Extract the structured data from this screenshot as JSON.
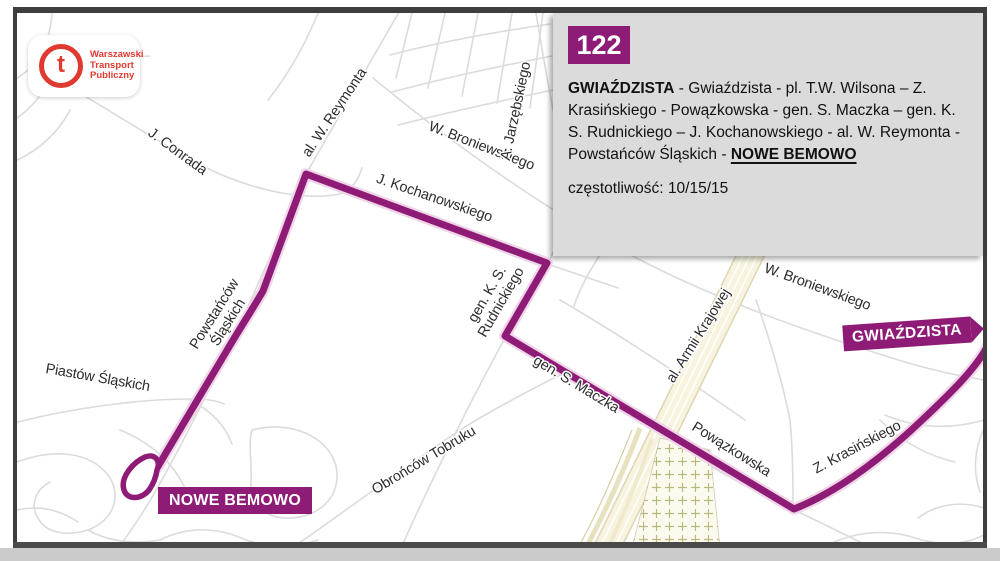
{
  "logo": {
    "t_letter": "t",
    "org_lines": [
      "Warszawski",
      "Transport",
      "Publiczny"
    ]
  },
  "info_box": {
    "route_number": "122",
    "route_from": "GWIAŹDZISTA",
    "route_middle": " - Gwiaździsta - pl. T.W. Wilsona – Z. Krasińskiego - Powązkowska - gen. S. Maczka – gen. K. S. Rudnickiego – J. Kochanowskiego - al. W. Reymonta - Powstańców Śląskich - ",
    "route_to": "NOWE BEMOWO",
    "frequency_label": "częstotliwość:",
    "frequency_value": "10/15/15"
  },
  "terminus_flags": {
    "gwiazdzista": "GWIAŹDZISTA",
    "nowe_bemowo": "NOWE BEMOWO"
  },
  "map": {
    "street_labels": [
      "J. Conrada",
      "al. W. Reymonta",
      "W. Broniewskiego",
      "A. Jarzębskiego",
      "J. Kochanowskiego",
      "gen. K. S.",
      "Rudnickiego",
      "gen. S. Maczka",
      "Obrońców Tobruku",
      "Piastów Śląskich",
      "Powstańców",
      "Śląskich",
      "al. Armii  Krajowej",
      "W. Broniewskiego",
      "Powązkowska",
      "Z. Krasińskiego"
    ]
  },
  "colors": {
    "route": "#8E1B76",
    "route_halo": "#F0D5E8",
    "roads": "#DBDBDB",
    "highway_fill": "#F7F3DF",
    "highway_edge": "#DDD6B4",
    "cemetery_fill": "#FCFAEE",
    "cemetery_cross": "#B9B97C",
    "frame": "#3E3E3E",
    "info_box_bg": "#DBDBDB",
    "logo_red": "#E0392F",
    "label_text": "#2D2D2D"
  }
}
